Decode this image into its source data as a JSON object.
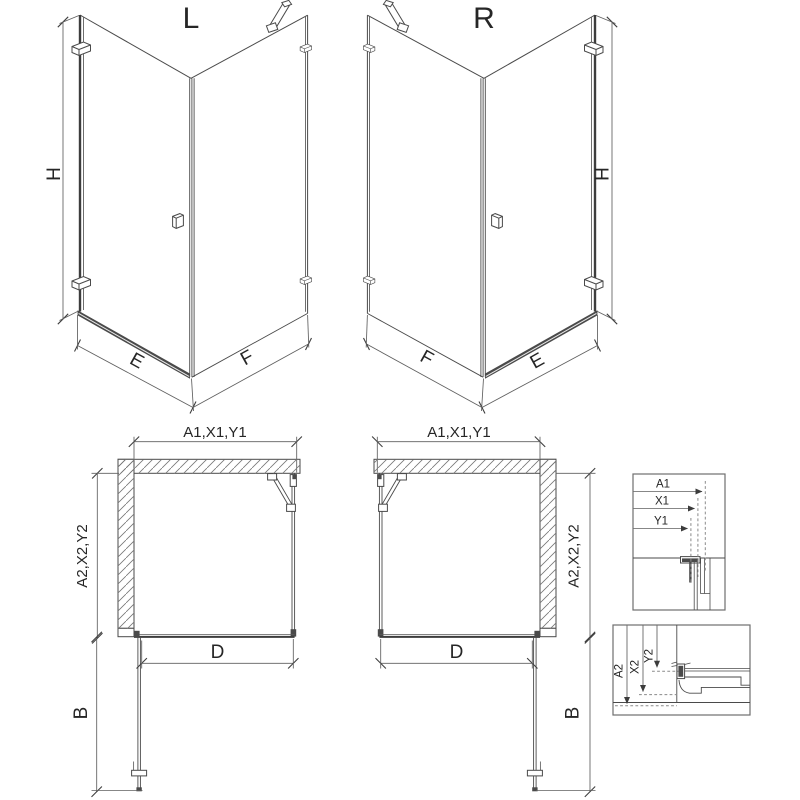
{
  "colors": {
    "background": "#ffffff",
    "line": "#4a4a4a",
    "thick_line": "#3d3d3d",
    "dimension_line": "#5f5f5f",
    "dashed_reference": "#8a8a8a",
    "hatch": "#777777",
    "dark_profile_fill": "#4a4a4a",
    "text": "#262626"
  },
  "views": {
    "perspective_left": {
      "title": "L",
      "height": "H",
      "front_width": "E",
      "side_width": "F"
    },
    "perspective_right": {
      "title": "R",
      "height": "H",
      "front_width": "E",
      "side_width": "F"
    },
    "plan_left": {
      "top": "A1,X1,Y1",
      "side": "A2,X2,Y2",
      "opening": "D",
      "door_swing": "B"
    },
    "plan_right": {
      "top": "A1,X1,Y1",
      "side": "A2,X2,Y2",
      "opening": "D",
      "door_swing": "B"
    },
    "detail_wall_profile": {
      "a1": "A1",
      "x1": "X1",
      "y1": "Y1"
    },
    "detail_floor_profile": {
      "a2": "A2",
      "x2": "X2",
      "y2": "Y2"
    }
  }
}
